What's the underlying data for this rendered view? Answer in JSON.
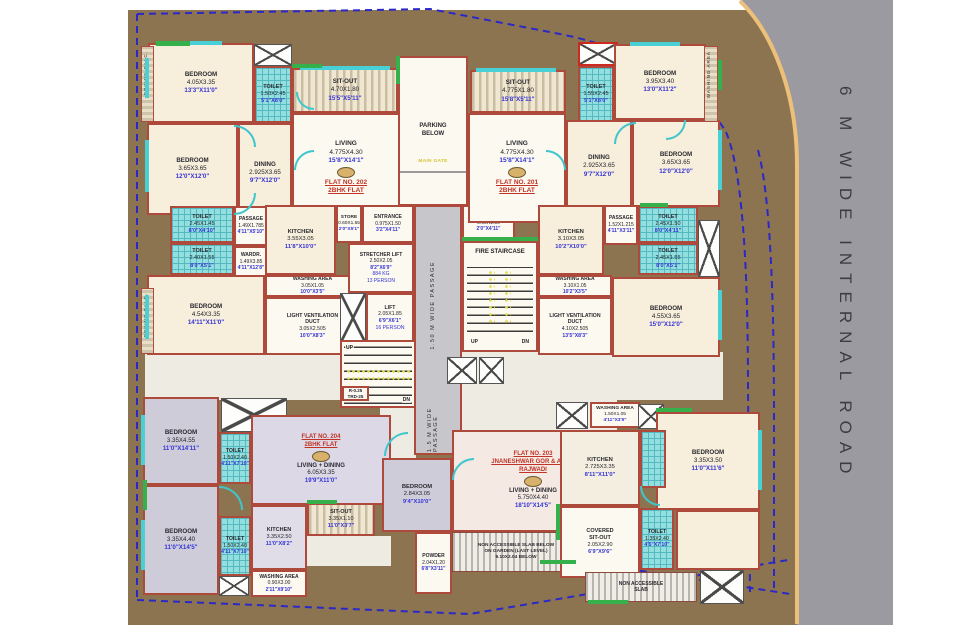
{
  "misc": {
    "road": "6 M WIDE INTERNAL ROAD",
    "passage_upper": "1.50 M WIDE PASSAGE",
    "passage_lower": "1.5 M WIDE PASSAGE",
    "main_gate": "MAIN GATE",
    "fire": "FIRE STAIRCASE",
    "up": "UP",
    "dn": "DN"
  },
  "flats": [
    {
      "lines": [
        "FLAT NO. 202",
        "2BHK FLAT"
      ]
    },
    {
      "lines": [
        "FLAT NO. 201",
        "2BHK FLAT"
      ]
    },
    {
      "lines": [
        "FLAT NO. 203",
        "JNANESHWAR GOR & AMRA",
        "RAJWADI"
      ]
    },
    {
      "lines": [
        "FLAT NO. 204",
        "2BHK FLAT"
      ]
    }
  ],
  "rooms": [
    {
      "id": "bedroom-202-a",
      "lines": [
        "BEDROOM",
        "4.05X3.35",
        "13'3\"X11'0\""
      ]
    },
    {
      "id": "toilet-202-a",
      "lines": [
        "TOILET",
        "1.50X2.45",
        "5'1\"X8'0\""
      ]
    },
    {
      "id": "sitout-202",
      "lines": [
        "SIT-OUT",
        "4.70X1.80",
        "15'5\"X5'11\""
      ]
    },
    {
      "id": "living-202",
      "lines": [
        "LIVING",
        "4.775X4.30",
        "15'8\"X14'1\""
      ]
    },
    {
      "id": "dining-202",
      "lines": [
        "DINING",
        "2.925X3.65",
        "9'7\"X12'0\""
      ]
    },
    {
      "id": "bedroom-202-b",
      "lines": [
        "BEDROOM",
        "3.65X3.65",
        "12'0\"X12'0\""
      ]
    },
    {
      "id": "toilet-202-b",
      "lines": [
        "TOILET",
        "2.45X1.45",
        "8'0\"X4'10\""
      ]
    },
    {
      "id": "toilet-202-c",
      "lines": [
        "TOILET",
        "2.40X1.55",
        "8'0\"X5'1\""
      ]
    },
    {
      "id": "passage-202",
      "lines": [
        "PASSAGE",
        "1.49X1.785",
        "4'11\"X5'10\""
      ]
    },
    {
      "id": "wardrobe-202",
      "lines": [
        "WARDR.",
        "1.49X3.85",
        "4'11\"X12'8\""
      ]
    },
    {
      "id": "bedroom-202-c",
      "lines": [
        "BEDROOM",
        "4.54X3.35",
        "14'11\"X11'0\""
      ]
    },
    {
      "id": "kitchen-202",
      "lines": [
        "KITCHEN",
        "3.55X3.05",
        "11'8\"X10'0\""
      ]
    },
    {
      "id": "store-202",
      "lines": [
        "STORE",
        "0.60X1.55",
        "2'0\"X5'1\""
      ]
    },
    {
      "id": "washing-202",
      "lines": [
        "WASHING AREA",
        "3.05X1.05",
        "10'0\"X3'5\""
      ]
    },
    {
      "id": "lvd-202",
      "lines": [
        "LIGHT VENTILATION",
        "DUCT",
        "3.05X2.505",
        "10'0\"X8'3\""
      ]
    },
    {
      "id": "entrance-202",
      "lines": [
        "ENTRANCE",
        "0.975X1.50",
        "3'2\"X4'11\""
      ]
    },
    {
      "id": "stretcher-lift",
      "lines": [
        "STRETCHER LIFT",
        "2.50X2.05",
        "8'2\"X6'9\"",
        "884 KG",
        "13 PERSON"
      ]
    },
    {
      "id": "lift",
      "lines": [
        "LIFT",
        "2.05X1.85",
        "6'9\"X6'1\"",
        "16 PERSON"
      ]
    },
    {
      "id": "entrance-201",
      "lines": [
        "ENTRANCE",
        "0.60X1.50",
        "2'0\"X4'11\""
      ]
    },
    {
      "id": "sitout-201",
      "lines": [
        "SIT-OUT",
        "4.775X1.80",
        "15'8\"X5'11\""
      ]
    },
    {
      "id": "living-201",
      "lines": [
        "LIVING",
        "4.775X4.30",
        "15'8\"X14'1\""
      ]
    },
    {
      "id": "toilet-201-a",
      "lines": [
        "TOILET",
        "1.55X2.45",
        "5'1\"X8'0\""
      ]
    },
    {
      "id": "bedroom-201-a",
      "lines": [
        "BEDROOM",
        "3.95X3.40",
        "13'0\"X11'2\""
      ]
    },
    {
      "id": "dining-201",
      "lines": [
        "DINING",
        "2.925X3.65",
        "9'7\"X12'0\""
      ]
    },
    {
      "id": "bedroom-201-b",
      "lines": [
        "BEDROOM",
        "3.65X3.65",
        "12'0\"X12'0\""
      ]
    },
    {
      "id": "kitchen-201",
      "lines": [
        "KITCHEN",
        "3.10X3.05",
        "10'2\"X10'0\""
      ]
    },
    {
      "id": "passage-201",
      "lines": [
        "PASSAGE",
        "1.52X1.215",
        "4'11\"X3'11\""
      ]
    },
    {
      "id": "toilet-201-b",
      "lines": [
        "TOILET",
        "2.45X1.50",
        "8'0\"X4'11\""
      ]
    },
    {
      "id": "toilet-201-c",
      "lines": [
        "TOILET",
        "2.45X1.55",
        "8'0\"X5'1\""
      ]
    },
    {
      "id": "bedroom-201-c",
      "lines": [
        "BEDROOM",
        "4.55X3.65",
        "15'0\"X12'0\""
      ]
    },
    {
      "id": "washing-201",
      "lines": [
        "WASHING AREA",
        "3.10X1.05",
        "10'2\"X3'5\""
      ]
    },
    {
      "id": "lvd-201",
      "lines": [
        "LIGHT VENTILATION",
        "DUCT",
        "4.10X2.505",
        "13'5\"X8'3\""
      ]
    },
    {
      "id": "bedroom-204-a",
      "lines": [
        "BEDROOM",
        "3.35X4.55",
        "11'0\"X14'11\""
      ]
    },
    {
      "id": "toilet-204-a",
      "lines": [
        "TOILET",
        "1.50X2.40",
        "4'11\"X7'10\""
      ]
    },
    {
      "id": "livdin-204",
      "lines": [
        "LIVING + DINING",
        "6.05X3.35",
        "19'9\"X11'0\""
      ]
    },
    {
      "id": "bedroom-204-b",
      "lines": [
        "BEDROOM",
        "3.35X4.40",
        "11'0\"X14'5\""
      ]
    },
    {
      "id": "toilet-204-b",
      "lines": [
        "TOILET",
        "1.50X2.40",
        "4'11\"X7'10\""
      ]
    },
    {
      "id": "kitchen-204",
      "lines": [
        "KITCHEN",
        "3.35X2.50",
        "11'0\"X8'2\""
      ]
    },
    {
      "id": "washing-204",
      "lines": [
        "WASHING AREA",
        "0.90X3.00",
        "2'11\"X9'10\""
      ]
    },
    {
      "id": "sitout-204",
      "lines": [
        "SIT-OUT",
        "3.35X1.10",
        "11'0\"X3'7\""
      ]
    },
    {
      "id": "bedroom-203",
      "lines": [
        "BEDROOM",
        "2.84X3.05",
        "9'4\"X10'0\""
      ]
    },
    {
      "id": "livdin-203",
      "lines": [
        "LIVING + DINING",
        "5.750X4.40",
        "18'10\"X14'5\""
      ]
    },
    {
      "id": "powder-203",
      "lines": [
        "POWDER",
        "2.04X1.20",
        "6'8\"X3'11\""
      ]
    },
    {
      "id": "slab-203",
      "lines": [
        "NON ACCESSIBLE SLAB BELOW",
        "ON GARDEN (LAST LEVEL)",
        "9.10X2.04 BELOW"
      ]
    },
    {
      "id": "washing-205",
      "lines": [
        "WASHING AREA",
        "1.50X1.05",
        "4'11\"X3'5\""
      ]
    },
    {
      "id": "kitchen-205",
      "lines": [
        "KITCHEN",
        "2.725X3.35",
        "8'11\"X11'0\""
      ]
    },
    {
      "id": "bedroom-205",
      "lines": [
        "BEDROOM",
        "3.35X3.50",
        "11'0\"X11'6\""
      ]
    },
    {
      "id": "covered-sitout-205",
      "lines": [
        "COVERED",
        "SIT-OUT",
        "2.05X2.90",
        "6'9\"X9'6\""
      ]
    },
    {
      "id": "toilet-205",
      "lines": [
        "TOILET",
        "1.35X2.40",
        "4'5\"X7'10\""
      ]
    },
    {
      "id": "slab-205",
      "lines": [
        "NON ACCESSIBLE",
        "SLAB"
      ]
    },
    {
      "id": "tread-note",
      "lines": [
        "R-0.25",
        "TRD-25"
      ]
    },
    {
      "id": "drying-balc-1",
      "lines": [
        "DRYING BALC."
      ]
    },
    {
      "id": "drying-balc-2",
      "lines": [
        "DRYING BALC."
      ]
    },
    {
      "id": "washing-strip",
      "lines": [
        "WASHING AREA"
      ]
    },
    {
      "id": "parking",
      "lines": [
        "PARKING",
        "BELOW"
      ]
    }
  ],
  "colors": {
    "site": "#8d7450",
    "road": "#9b9aa0",
    "wall": "#ad4a3c",
    "boundary": "#2a28c8",
    "curb": "#edc07a",
    "window": "#49cfd6",
    "green_wall": "#35b04a",
    "dim_blue": "#3434d6",
    "flat_red": "#c03326",
    "gate_yellow": "#d7c22e"
  }
}
